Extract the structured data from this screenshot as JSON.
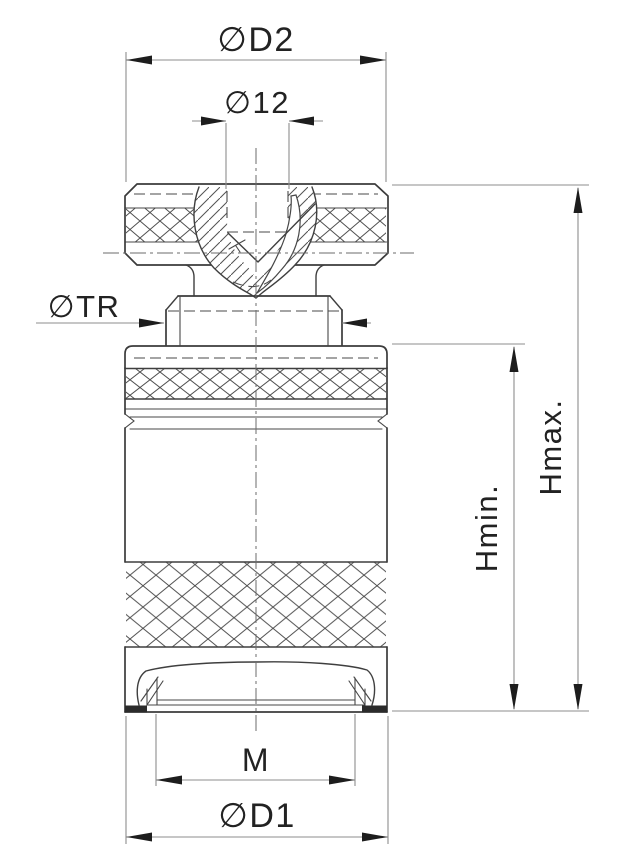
{
  "drawing": {
    "kind": "technical dimension drawing, front section view",
    "background": "#ffffff",
    "object_line_color": "#3b3b3b",
    "hidden_line_color": "#4a4a4a",
    "centerline_color": "#6b6b6b",
    "dimension_line_color": "#8e8e8e",
    "arrow_color": "#1d1d1d",
    "text_color": "#222222"
  },
  "labels": {
    "d2": "∅D2",
    "d12": "∅12",
    "tr": "∅TR",
    "hmax": "Hmax.",
    "hmin": "Hmin.",
    "m": "M",
    "d1": "∅D1"
  }
}
